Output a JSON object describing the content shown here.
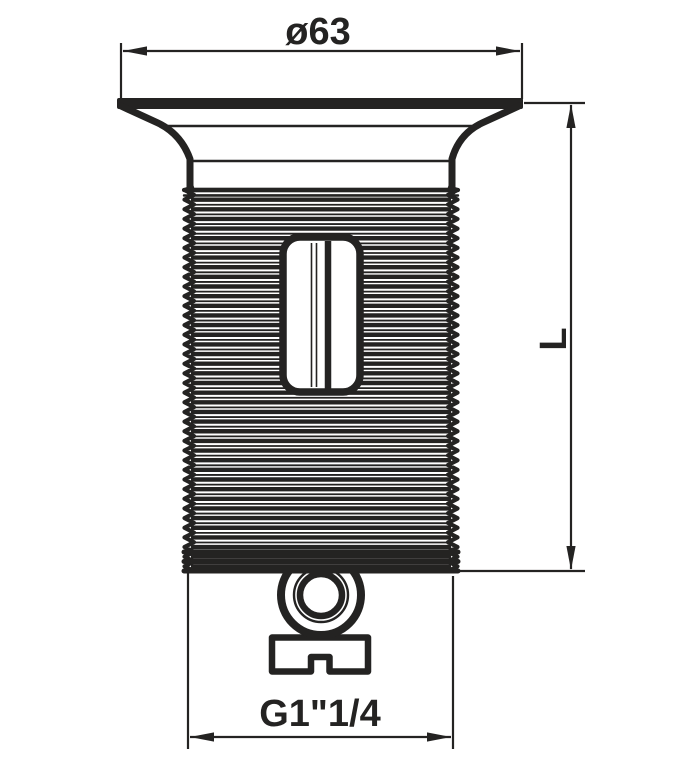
{
  "drawing": {
    "description": "Technical line drawing of a flanged threaded drain fitting (side elevation) with three dimensions",
    "part_features": [
      "flared top flange",
      "external pipe thread body",
      "side slot window",
      "bottom coupling ring",
      "slotted fixing tab"
    ],
    "colors": {
      "ink": "#242322",
      "background": "#ffffff"
    },
    "dimensions": {
      "top_diameter": {
        "label": "ø63",
        "meaning": "flange outer diameter 63 mm"
      },
      "right_length": {
        "label": "L",
        "meaning": "overall threaded length"
      },
      "bottom_thread": {
        "label": "G1\"1/4",
        "meaning": "thread size G 1 1/4 inch"
      }
    }
  }
}
